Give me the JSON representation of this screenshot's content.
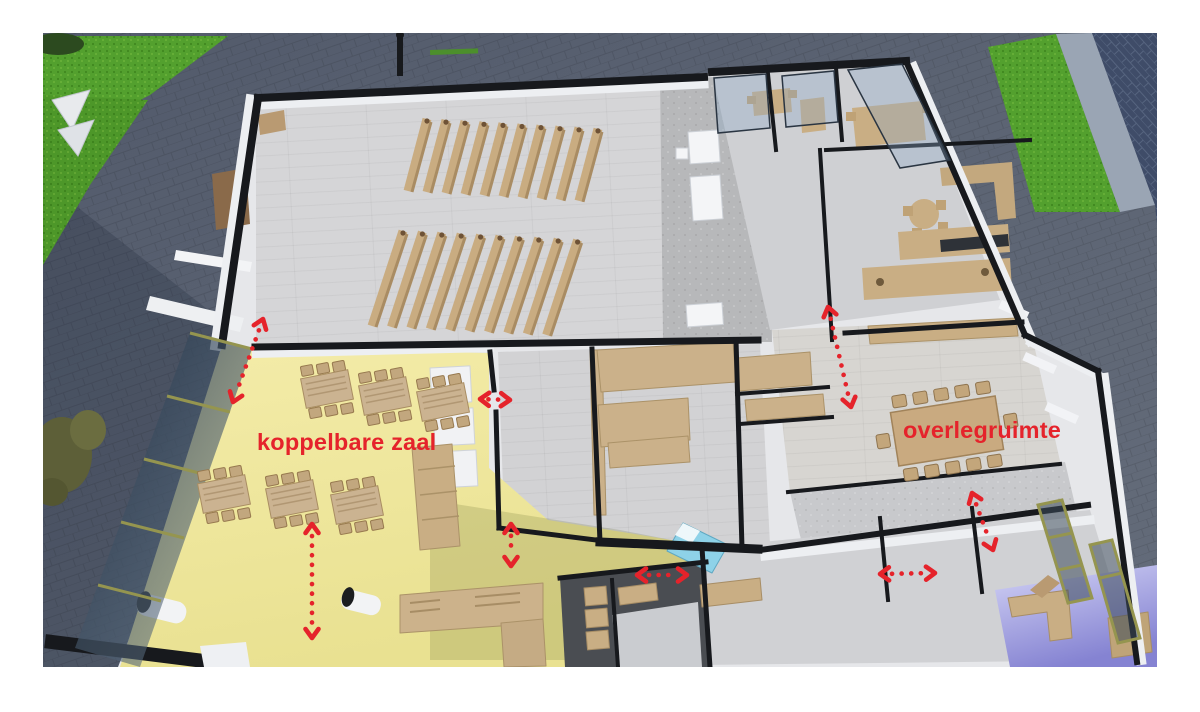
{
  "scene": {
    "kind": "3d-floorplan-cutaway-render",
    "annotation_color": "#e5232b",
    "labels": [
      {
        "id": "label-koppelbare-zaal",
        "text": "koppelbare zaal",
        "x": 257,
        "y": 429,
        "size": 23.5
      },
      {
        "id": "label-overlegruimte",
        "text": "overlegruimte",
        "x": 903,
        "y": 417,
        "size": 23.5
      }
    ],
    "arrows": [
      {
        "id": "arrow-hall-to-foyer",
        "x1": 263,
        "y1": 319,
        "x2": 233,
        "y2": 402
      },
      {
        "id": "arrow-corridor-link",
        "x1": 480,
        "y1": 399,
        "x2": 510,
        "y2": 400
      },
      {
        "id": "arrow-corridor-down",
        "x1": 511,
        "y1": 524,
        "x2": 511,
        "y2": 566
      },
      {
        "id": "arrow-zaal-vertical",
        "x1": 312,
        "y1": 524,
        "x2": 312,
        "y2": 638
      },
      {
        "id": "arrow-kitchen-link",
        "x1": 637,
        "y1": 575,
        "x2": 687,
        "y2": 575
      },
      {
        "id": "arrow-right-corridor",
        "x1": 828,
        "y1": 307,
        "x2": 851,
        "y2": 407
      },
      {
        "id": "arrow-overleg-diagonal",
        "x1": 972,
        "y1": 493,
        "x2": 993,
        "y2": 550
      },
      {
        "id": "arrow-bottom-corridor",
        "x1": 880,
        "y1": 574,
        "x2": 935,
        "y2": 573
      }
    ],
    "bench_groups": [
      {
        "x": 427,
        "y": 119,
        "count": 10,
        "spacing": 19.0,
        "rise": 1.1,
        "length": 72,
        "lean": 19
      },
      {
        "x": 403,
        "y": 231,
        "count": 10,
        "spacing": 19.4,
        "rise": 1.0,
        "length": 95,
        "lean": 31
      }
    ],
    "yellow_tables": [
      {
        "cx": 327,
        "cy": 389
      },
      {
        "cx": 385,
        "cy": 396
      },
      {
        "cx": 443,
        "cy": 402
      },
      {
        "cx": 224,
        "cy": 494
      },
      {
        "cx": 292,
        "cy": 499
      },
      {
        "cx": 357,
        "cy": 505
      }
    ],
    "meeting_table": {
      "cx": 947,
      "cy": 431,
      "w": 106,
      "h": 54,
      "rot": -9,
      "chairs_long": 5,
      "chairs_short": 1
    },
    "colors": {
      "background": "#ffffff",
      "pavement": "#5b6372",
      "pavement_shadow": "#454c5e",
      "grass": "#53a02e",
      "grass_dark": "#3d7c1f",
      "road": "#3f4c68",
      "sidewalk": "#9aa5b4",
      "wall_cut": "#17191d",
      "wall_face": "#edeff2",
      "hall_floor": "#d5d5d7",
      "concrete": "#b7b8ba",
      "wood_floor": "#d7d5d1",
      "yellow_floor": "#f1e9a4",
      "yellow_shadow": "rgba(100,105,45,0.20)",
      "lavender_floor": "#aeace6",
      "furniture": "#c9ac81",
      "furniture_dark": "#a98c63",
      "glass": "rgba(40,58,78,0.72)",
      "frame_olive": "#95954f",
      "bed_blue": "#8ed2e8"
    }
  }
}
